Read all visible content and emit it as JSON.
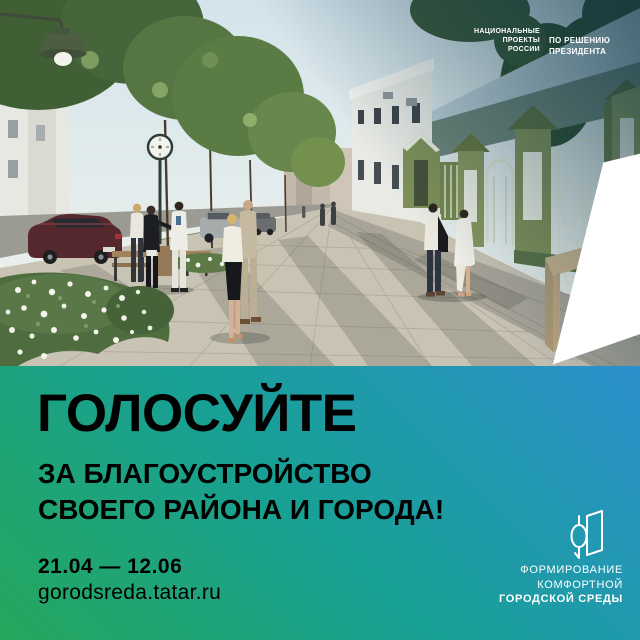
{
  "npr_logo": {
    "lines": [
      "НАЦИОНАЛЬНЫЕ",
      "ПРОЕКТЫ",
      "РОССИИ"
    ],
    "icon": "white-flag-icon"
  },
  "president_note": {
    "lines": [
      "ПО РЕШЕНИЮ",
      "ПРЕЗИДЕНТА"
    ]
  },
  "main": {
    "headline": "ГОЛОСУЙТЕ",
    "subheadline_line1": "ЗА БЛАГОУСТРОЙСТВО",
    "subheadline_line2": "СВОЕГО РАЙОНА И ГОРОДА!",
    "dates": "21.04 — 12.06",
    "website": "gorodsreda.tatar.ru"
  },
  "fkgs_logo": {
    "lines": [
      "ФОРМИРОВАНИЕ",
      "КОМФОРТНОЙ",
      "ГОРОДСКОЙ СРЕДЫ"
    ],
    "icon": "house-sprout-icon"
  },
  "colors": {
    "gradient_top_right": "#2b90cc",
    "gradient_middle": "#18a095",
    "gradient_bottom_left": "#25a75c",
    "text": "#ffffff"
  },
  "scene": {
    "type": "architectural street render",
    "elements": [
      "trees",
      "street-clock",
      "vintage-lamp",
      "parked-cars",
      "pedestrians",
      "flower-beds",
      "benches",
      "historic green buildings with gates",
      "paved promenade"
    ]
  }
}
